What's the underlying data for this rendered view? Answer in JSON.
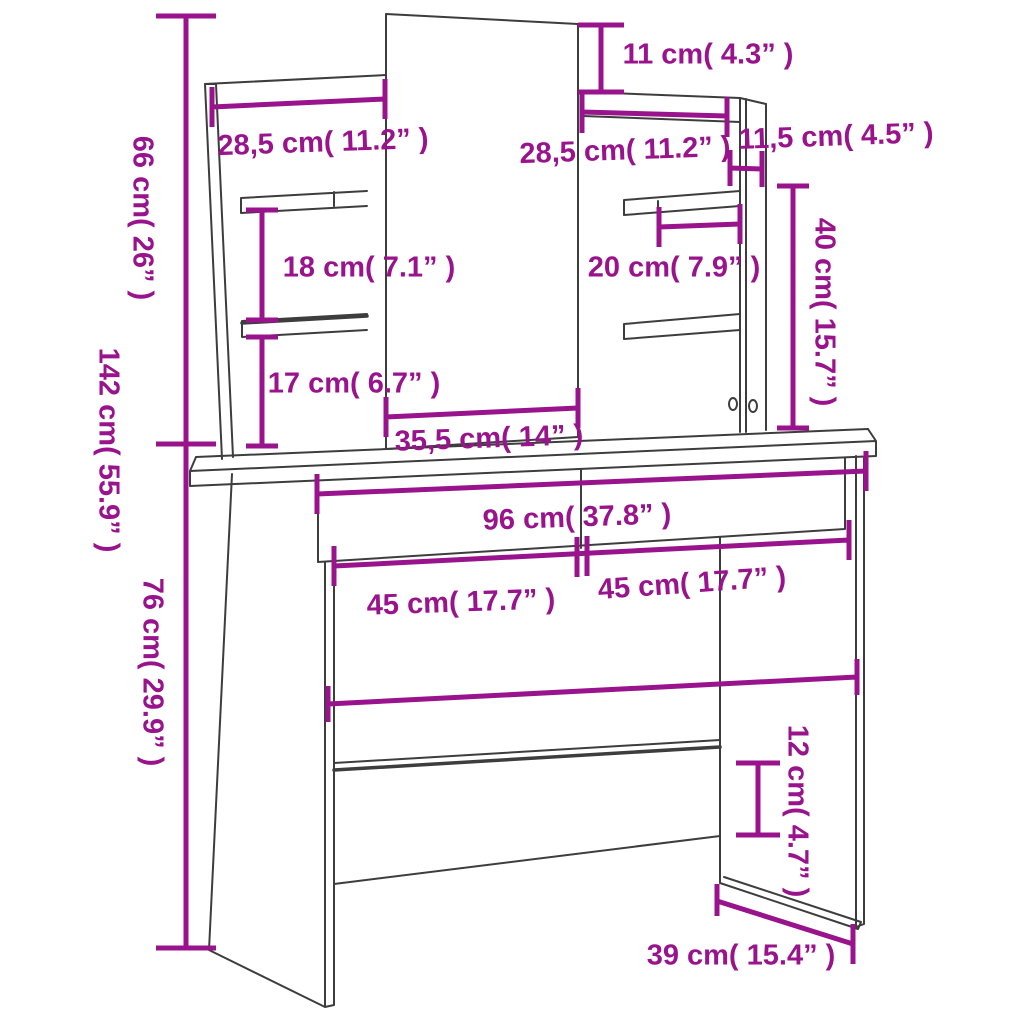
{
  "diagram": {
    "kind": "furniture-dimension-diagram",
    "subject": "dressing table with mirror, side shelf towers, drawers and stretcher",
    "colors": {
      "dimension_accent": "#99138C",
      "outline": "#3D3D3D",
      "background": "#FFFFFF"
    }
  },
  "dims": {
    "mirror_top_offset": {
      "cm": "11",
      "inch": "4.3",
      "label": "11 cm( 4.3” )",
      "orientation": "horizontal"
    },
    "left_shelf_width": {
      "cm": "28,5",
      "inch": "11.2",
      "label": "28,5 cm( 11.2” )",
      "orientation": "horizontal"
    },
    "right_shelf_width": {
      "cm": "28,5",
      "inch": "11.2",
      "label": "28,5 cm( 11.2” )",
      "orientation": "horizontal"
    },
    "side_panel_depth": {
      "cm": "11,5",
      "inch": "4.5",
      "label": "11,5 cm( 4.5” )",
      "orientation": "horizontal"
    },
    "upper_section_height": {
      "cm": "66",
      "inch": "26",
      "label": "66 cm( 26” )",
      "orientation": "vertical"
    },
    "left_shelf_gap": {
      "cm": "18",
      "inch": "7.1",
      "label": "18 cm( 7.1” )",
      "orientation": "horizontal"
    },
    "right_shelf_gap": {
      "cm": "20",
      "inch": "7.9",
      "label": "20 cm( 7.9” )",
      "orientation": "horizontal"
    },
    "right_tower_height": {
      "cm": "40",
      "inch": "15.7",
      "label": "40 cm( 15.7” )",
      "orientation": "vertical"
    },
    "total_height": {
      "cm": "142",
      "inch": "55.9",
      "label": "142 cm( 55.9” )",
      "orientation": "vertical"
    },
    "shelf_to_tabletop": {
      "cm": "17",
      "inch": "6.7",
      "label": "17 cm( 6.7” )",
      "orientation": "horizontal"
    },
    "mirror_width": {
      "cm": "35,5",
      "inch": "14",
      "label": "35,5 cm( 14” )",
      "orientation": "horizontal"
    },
    "table_width": {
      "cm": "96",
      "inch": "37.8",
      "label": "96 cm( 37.8” )",
      "orientation": "horizontal"
    },
    "left_section_width": {
      "cm": "45",
      "inch": "17.7",
      "label": "45 cm( 17.7” )",
      "orientation": "horizontal"
    },
    "right_section_width": {
      "cm": "45",
      "inch": "17.7",
      "label": "45 cm( 17.7” )",
      "orientation": "horizontal"
    },
    "table_height": {
      "cm": "76",
      "inch": "29.9",
      "label": "76 cm( 29.9” )",
      "orientation": "vertical"
    },
    "stretcher_height": {
      "cm": "12",
      "inch": "4.7",
      "label": "12 cm( 4.7” )",
      "orientation": "vertical"
    },
    "table_depth": {
      "cm": "39",
      "inch": "15.4",
      "label": "39 cm( 15.4” )",
      "orientation": "horizontal"
    }
  }
}
